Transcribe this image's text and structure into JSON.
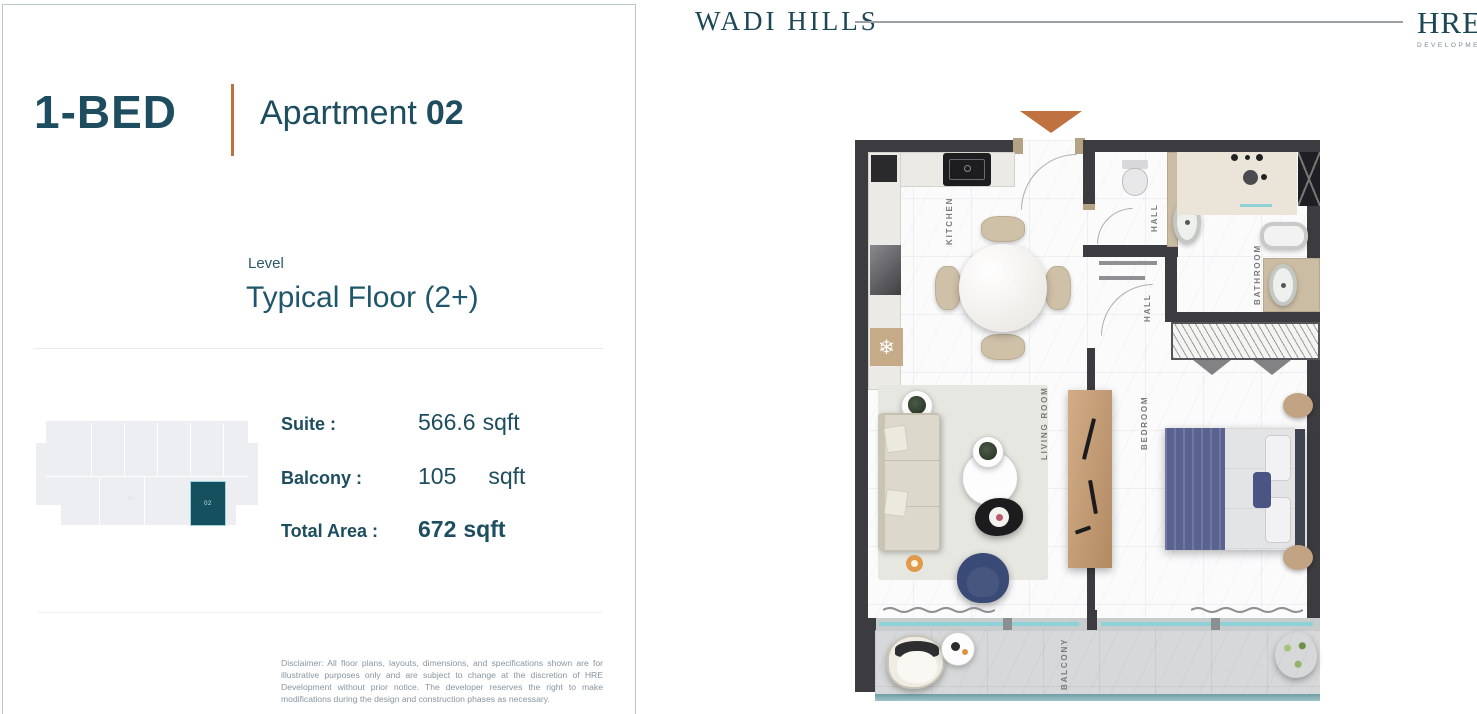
{
  "header": {
    "brand": "WADI HILLS",
    "developer": "HRE",
    "developer_sub": "DEVELOPMENT"
  },
  "panel": {
    "bed_type": "1-BED",
    "apartment_label": "Apartment",
    "apartment_number": "02",
    "level_label": "Level",
    "level_value": "Typical Floor (2+)",
    "areas": [
      {
        "label": "Suite :",
        "value": "566.6",
        "unit": "sqft"
      },
      {
        "label": "Balcony :",
        "value": "105",
        "unit": "sqft"
      },
      {
        "label": "Total Area :",
        "value": "672",
        "unit": "sqft"
      }
    ],
    "keyplan": {
      "highlight_unit": "02",
      "other_unit": "01"
    },
    "disclaimer": "Disclaimer: All floor plans, layouts, dimensions, and specifications shown are for illustrative purposes only and are subject to change at the discretion of HRE Development without prior notice. The developer reserves the right to make modifications during the design and construction phases as necessary."
  },
  "floorplan": {
    "labels": {
      "kitchen": "KITCHEN",
      "hall_upper": "HALL",
      "hall_lower": "HALL",
      "bathroom": "BATHROOM",
      "living_room": "LIVING ROOM",
      "bedroom": "BEDROOM",
      "balcony": "BALCONY"
    }
  },
  "colors": {
    "accent_teal": "#1d4d5e",
    "accent_orange": "#bf6f3c",
    "wall": "#3c3c40",
    "keyplan_highlight": "#15505f"
  }
}
